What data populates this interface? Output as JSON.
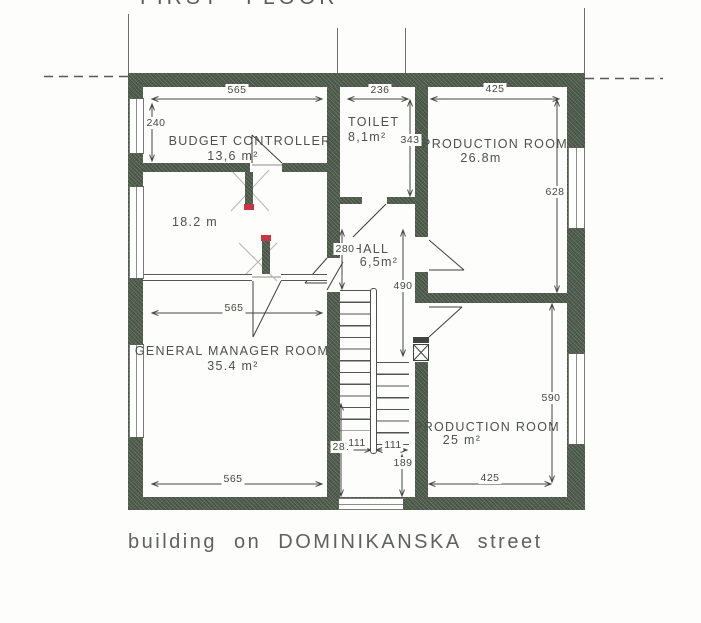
{
  "title": "FIRST FLOOR",
  "caption": "building on DOMINIKANSKA street",
  "rooms": {
    "budget": {
      "name": "BUDGET CONTROLLER",
      "area": "13,6 m²"
    },
    "toilet": {
      "name": "TOILET",
      "area": "8,1m²"
    },
    "production_top": {
      "name": "PRODUCTION ROOM",
      "area": "26.8m"
    },
    "room_18": {
      "area": "18.2 m"
    },
    "hall": {
      "name": "HALL",
      "area": "6,5m²"
    },
    "general_manager": {
      "name": "GENERAL MANAGER ROOM",
      "area": "35.4 m²"
    },
    "production_bottom": {
      "name": "PRODUCTION ROOM",
      "area": "25 m²"
    }
  },
  "dimensions": {
    "top_budget_width": "565",
    "top_toilet_width": "236",
    "top_production_width": "425",
    "budget_height": "240",
    "toilet_height": "343",
    "production_top_height": "628",
    "hall_width": "280",
    "hall_height": "490",
    "mid_gm_width": "565",
    "production_bottom_height": "590",
    "stair_run": "287",
    "stair_width_left": "111",
    "stair_width_right": "111",
    "stair_landing": "189",
    "bottom_gm_width": "565",
    "bottom_production_width": "425"
  },
  "colors": {
    "wall": "#52604f",
    "marker_red": "#c73642",
    "line": "#4a4f48",
    "text": "#4b514b"
  }
}
